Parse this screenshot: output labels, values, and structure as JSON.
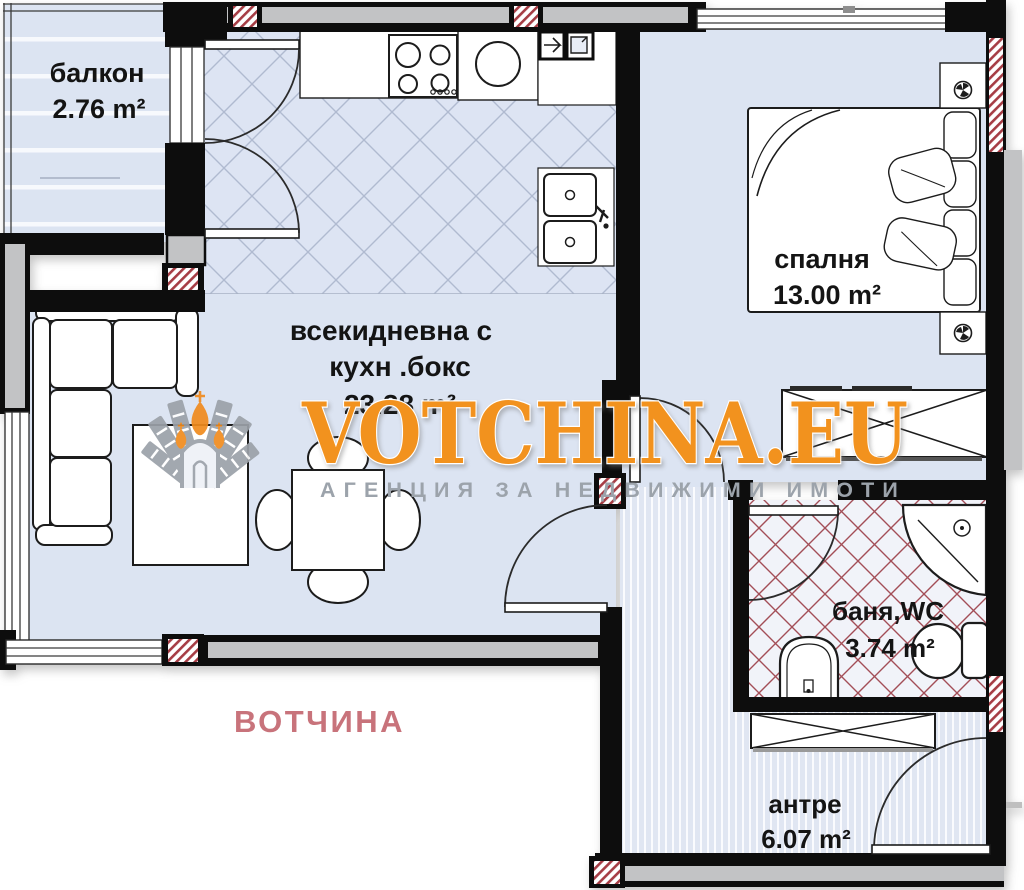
{
  "floor_plan": {
    "rooms": [
      {
        "id": "balcony",
        "name": "балкон",
        "name2": "",
        "area": "2.76 m²"
      },
      {
        "id": "living",
        "name": "всекидневна с",
        "name2": "кухн .бокс",
        "area": "23.28 m²"
      },
      {
        "id": "bedroom",
        "name": "спалня",
        "name2": "",
        "area": "13.00 m²"
      },
      {
        "id": "bathroom",
        "name": "баня,WC",
        "name2": "",
        "area": "3.74 m²"
      },
      {
        "id": "entry",
        "name": "антре",
        "name2": "",
        "area": "6.07 m²"
      }
    ]
  },
  "watermark": {
    "brand": "VOTCHINA.EU",
    "tagline": "АГЕНЦИЯ ЗА НЕДВИЖИМИ ИМОТИ",
    "agency_name": "ВОТЧИНА",
    "brand_color": "#F2921E",
    "tagline_color": "#9CA3AB",
    "agency_color": "#C8737B"
  },
  "colors": {
    "floor_blue": "#DCE4F2",
    "wall_black": "#0D0D0D",
    "wall_gray": "#C2C3C5",
    "pillar_hatch_red": "#A63D45",
    "bath_tile_red": "#A34E57"
  }
}
